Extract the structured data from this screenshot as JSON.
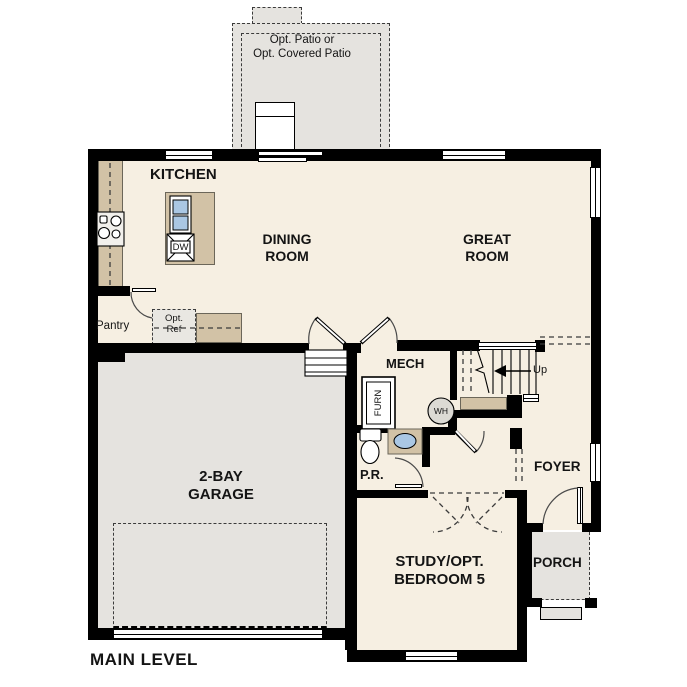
{
  "plan_title": "MAIN LEVEL",
  "patio": {
    "line1": "Opt. Patio or",
    "line2": "Opt. Covered Patio"
  },
  "rooms": {
    "kitchen": "KITCHEN",
    "dining_room": "DINING ROOM",
    "great_room": "GREAT ROOM",
    "mech": "MECH",
    "garage": "2-BAY GARAGE",
    "powder_room": "P.R.",
    "foyer": "FOYER",
    "study": "STUDY/OPT. BEDROOM 5",
    "porch": "PORCH",
    "pantry": "Pantry"
  },
  "labels": {
    "opt_ref": "Opt. Ref",
    "dishwasher": "DW",
    "furnace": "FURN",
    "water_heater": "WH",
    "stairs_up": "Up"
  },
  "colors": {
    "floor": "#f6efe2",
    "exterior_gray": "#e5e3df",
    "counter_tan": "#d2c2a6",
    "sink_blue": "#aac7e4",
    "wall_black": "#000000"
  }
}
